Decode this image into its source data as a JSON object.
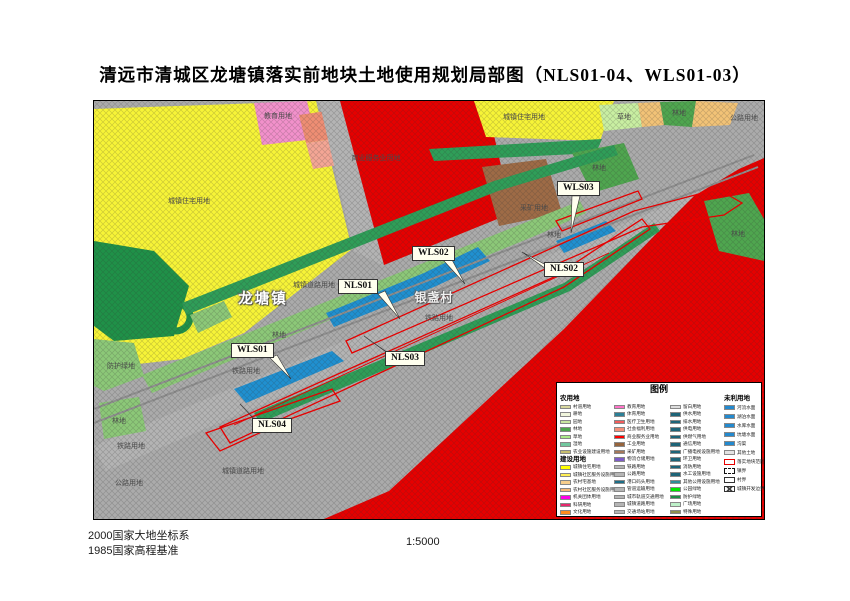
{
  "title": "清远市清城区龙塘镇落实前地块土地使用规划局部图（NLS01-04、WLS01-03）",
  "footer": {
    "datum1": "2000国家大地坐标系",
    "datum2": "1985国家高程基准",
    "scale": "1:5000"
  },
  "legend": {
    "title": "图例",
    "columns": [
      {
        "groups": [
          {
            "header": "农用地",
            "items": [
              {
                "label": "村道用地",
                "color": "#D7D79E",
                "type": "swatch"
              },
              {
                "label": "耕地",
                "color": "#F0F5DC",
                "type": "swatch"
              },
              {
                "label": "园地",
                "color": "#C8E6A0",
                "type": "swatch"
              },
              {
                "label": "林地",
                "color": "#4CA64C",
                "type": "swatch"
              },
              {
                "label": "草地",
                "color": "#AAEB87",
                "type": "swatch"
              },
              {
                "label": "湿地",
                "color": "#71C79E",
                "type": "swatch"
              },
              {
                "label": "农业设施建设用地",
                "color": "#C8BE6E",
                "type": "swatch"
              }
            ]
          },
          {
            "header": "建设用地",
            "items": [
              {
                "label": "城镇住宅用地",
                "color": "#FFFF00",
                "type": "swatch"
              },
              {
                "label": "城镇社区服务设施用地",
                "color": "#FFEE55",
                "type": "swatch"
              },
              {
                "label": "农村宅基地",
                "color": "#F7CE8C",
                "type": "swatch"
              },
              {
                "label": "农村社区服务设施用地",
                "color": "#F5B878",
                "type": "swatch"
              },
              {
                "label": "机关团体用地",
                "color": "#FF00E6",
                "type": "swatch"
              },
              {
                "label": "科研用地",
                "color": "#E6286E",
                "type": "swatch"
              },
              {
                "label": "文化用地",
                "color": "#FF8C1E",
                "type": "swatch"
              }
            ]
          }
        ]
      },
      {
        "groups": [
          {
            "header": null,
            "items": [
              {
                "label": "教育用地",
                "color": "#FF73C8",
                "type": "swatch"
              },
              {
                "label": "体育用地",
                "color": "#2C7F96",
                "type": "swatch"
              },
              {
                "label": "医疗卫生用地",
                "color": "#F25C5C",
                "type": "swatch"
              },
              {
                "label": "社会福利用地",
                "color": "#F5907A",
                "type": "swatch"
              },
              {
                "label": "商业服务业用地",
                "color": "#FF0000",
                "type": "swatch"
              },
              {
                "label": "工业用地",
                "color": "#96643C",
                "type": "swatch"
              },
              {
                "label": "采矿用地",
                "color": "#A5785A",
                "type": "swatch"
              },
              {
                "label": "物流仓储用地",
                "color": "#7D5CC6",
                "type": "swatch"
              },
              {
                "label": "铁路用地",
                "color": "#B5B5B5",
                "type": "swatch"
              },
              {
                "label": "公路用地",
                "color": "#B5B5B5",
                "type": "swatch"
              },
              {
                "label": "港口码头用地",
                "color": "#1D6E87",
                "type": "swatch"
              },
              {
                "label": "管道运输用地",
                "color": "#B5B5B5",
                "type": "swatch"
              },
              {
                "label": "城市轨道交通用地",
                "color": "#B5B5B5",
                "type": "swatch"
              },
              {
                "label": "城镇道路用地",
                "color": "#B5B5B5",
                "type": "swatch"
              },
              {
                "label": "交通场站用地",
                "color": "#B5B5B5",
                "type": "swatch"
              }
            ]
          }
        ]
      },
      {
        "groups": [
          {
            "header": null,
            "items": [
              {
                "label": "留白用地",
                "color": "#DCDCDC",
                "type": "swatch"
              },
              {
                "label": "供水用地",
                "color": "#1D6478",
                "type": "swatch"
              },
              {
                "label": "排水用地",
                "color": "#1D6478",
                "type": "swatch"
              },
              {
                "label": "供电用地",
                "color": "#1D6478",
                "type": "swatch"
              },
              {
                "label": "供燃气用地",
                "color": "#1D6478",
                "type": "swatch"
              },
              {
                "label": "通信用地",
                "color": "#1D6478",
                "type": "swatch"
              },
              {
                "label": "广播电视设施用地",
                "color": "#1D6478",
                "type": "swatch"
              },
              {
                "label": "环卫用地",
                "color": "#1D6478",
                "type": "swatch"
              },
              {
                "label": "消防用地",
                "color": "#1D6478",
                "type": "swatch"
              },
              {
                "label": "水工设施用地",
                "color": "#1D6478",
                "type": "swatch"
              },
              {
                "label": "其他公用设施用地",
                "color": "#2D8C96",
                "type": "swatch"
              },
              {
                "label": "公园绿地",
                "color": "#00E600",
                "type": "swatch"
              },
              {
                "label": "防护绿地",
                "color": "#1E8C46",
                "type": "swatch"
              },
              {
                "label": "广场用地",
                "color": "#BDF0C8",
                "type": "swatch"
              },
              {
                "label": "特殊用地",
                "color": "#8F9150",
                "type": "swatch"
              }
            ]
          }
        ]
      },
      {
        "groups": [
          {
            "header": "未利用地",
            "items": [
              {
                "label": "河流水面",
                "color": "#2389CE",
                "type": "swatch"
              },
              {
                "label": "湖泊水面",
                "color": "#2389CE",
                "type": "swatch"
              },
              {
                "label": "水库水面",
                "color": "#2389CE",
                "type": "swatch"
              },
              {
                "label": "坑塘水面",
                "color": "#2389CE",
                "type": "swatch"
              },
              {
                "label": "沟渠",
                "color": "#2389CE",
                "type": "swatch"
              },
              {
                "label": "其他土地",
                "color": "#E3E3E3",
                "type": "swatch"
              },
              {
                "label": "落实地块范围",
                "color": "",
                "type": "outline-red"
              },
              {
                "label": "镇界",
                "color": "",
                "type": "dashed"
              },
              {
                "label": "村界",
                "color": "",
                "type": "plain"
              },
              {
                "label": "城镇开发边界",
                "color": "",
                "type": "crossed"
              }
            ]
          }
        ]
      }
    ]
  },
  "map": {
    "area_labels": [
      {
        "text": "教育用地",
        "x": 184,
        "y": 15,
        "kind": "area"
      },
      {
        "text": "城镇住宅用地",
        "x": 95,
        "y": 100,
        "kind": "area"
      },
      {
        "text": "商业服务业用地",
        "x": 282,
        "y": 57,
        "kind": "area"
      },
      {
        "text": "城镇住宅用地",
        "x": 430,
        "y": 16,
        "kind": "area"
      },
      {
        "text": "采矿用地",
        "x": 440,
        "y": 107,
        "kind": "area"
      },
      {
        "text": "草地",
        "x": 530,
        "y": 16,
        "kind": "area"
      },
      {
        "text": "林地",
        "x": 585,
        "y": 12,
        "kind": "area"
      },
      {
        "text": "公路用地",
        "x": 650,
        "y": 17,
        "kind": "area"
      },
      {
        "text": "林地",
        "x": 505,
        "y": 67,
        "kind": "area"
      },
      {
        "text": "林地",
        "x": 644,
        "y": 133,
        "kind": "area"
      },
      {
        "text": "林地",
        "x": 460,
        "y": 134,
        "kind": "area"
      },
      {
        "text": "城镇道路用地",
        "x": 220,
        "y": 184,
        "kind": "area"
      },
      {
        "text": "林地",
        "x": 185,
        "y": 234,
        "kind": "area"
      },
      {
        "text": "铁路用地",
        "x": 345,
        "y": 217,
        "kind": "area"
      },
      {
        "text": "铁路用地",
        "x": 152,
        "y": 270,
        "kind": "area"
      },
      {
        "text": "防护绿地",
        "x": 27,
        "y": 265,
        "kind": "area"
      },
      {
        "text": "林地",
        "x": 25,
        "y": 320,
        "kind": "area"
      },
      {
        "text": "铁路用地",
        "x": 37,
        "y": 345,
        "kind": "area"
      },
      {
        "text": "公路用地",
        "x": 35,
        "y": 382,
        "kind": "area"
      },
      {
        "text": "城镇道路用地",
        "x": 149,
        "y": 370,
        "kind": "area"
      },
      {
        "text": "龙塘镇",
        "x": 169,
        "y": 197,
        "kind": "town"
      },
      {
        "text": "银盏村",
        "x": 340,
        "y": 196,
        "kind": "village"
      }
    ],
    "callouts": [
      {
        "id": "NLS01",
        "x": 244,
        "y": 178
      },
      {
        "id": "NLS02",
        "x": 450,
        "y": 161
      },
      {
        "id": "NLS03",
        "x": 291,
        "y": 250
      },
      {
        "id": "NLS04",
        "x": 158,
        "y": 317
      },
      {
        "id": "WLS01",
        "x": 137,
        "y": 242
      },
      {
        "id": "WLS02",
        "x": 318,
        "y": 145
      },
      {
        "id": "WLS03",
        "x": 463,
        "y": 80
      }
    ]
  },
  "colors": {
    "plot_outline": "#E60000",
    "water": "#2090D0",
    "commercial_red": "#E60000",
    "residential_yellow": "#F7F437",
    "road_gray": "#B4B4B4"
  }
}
